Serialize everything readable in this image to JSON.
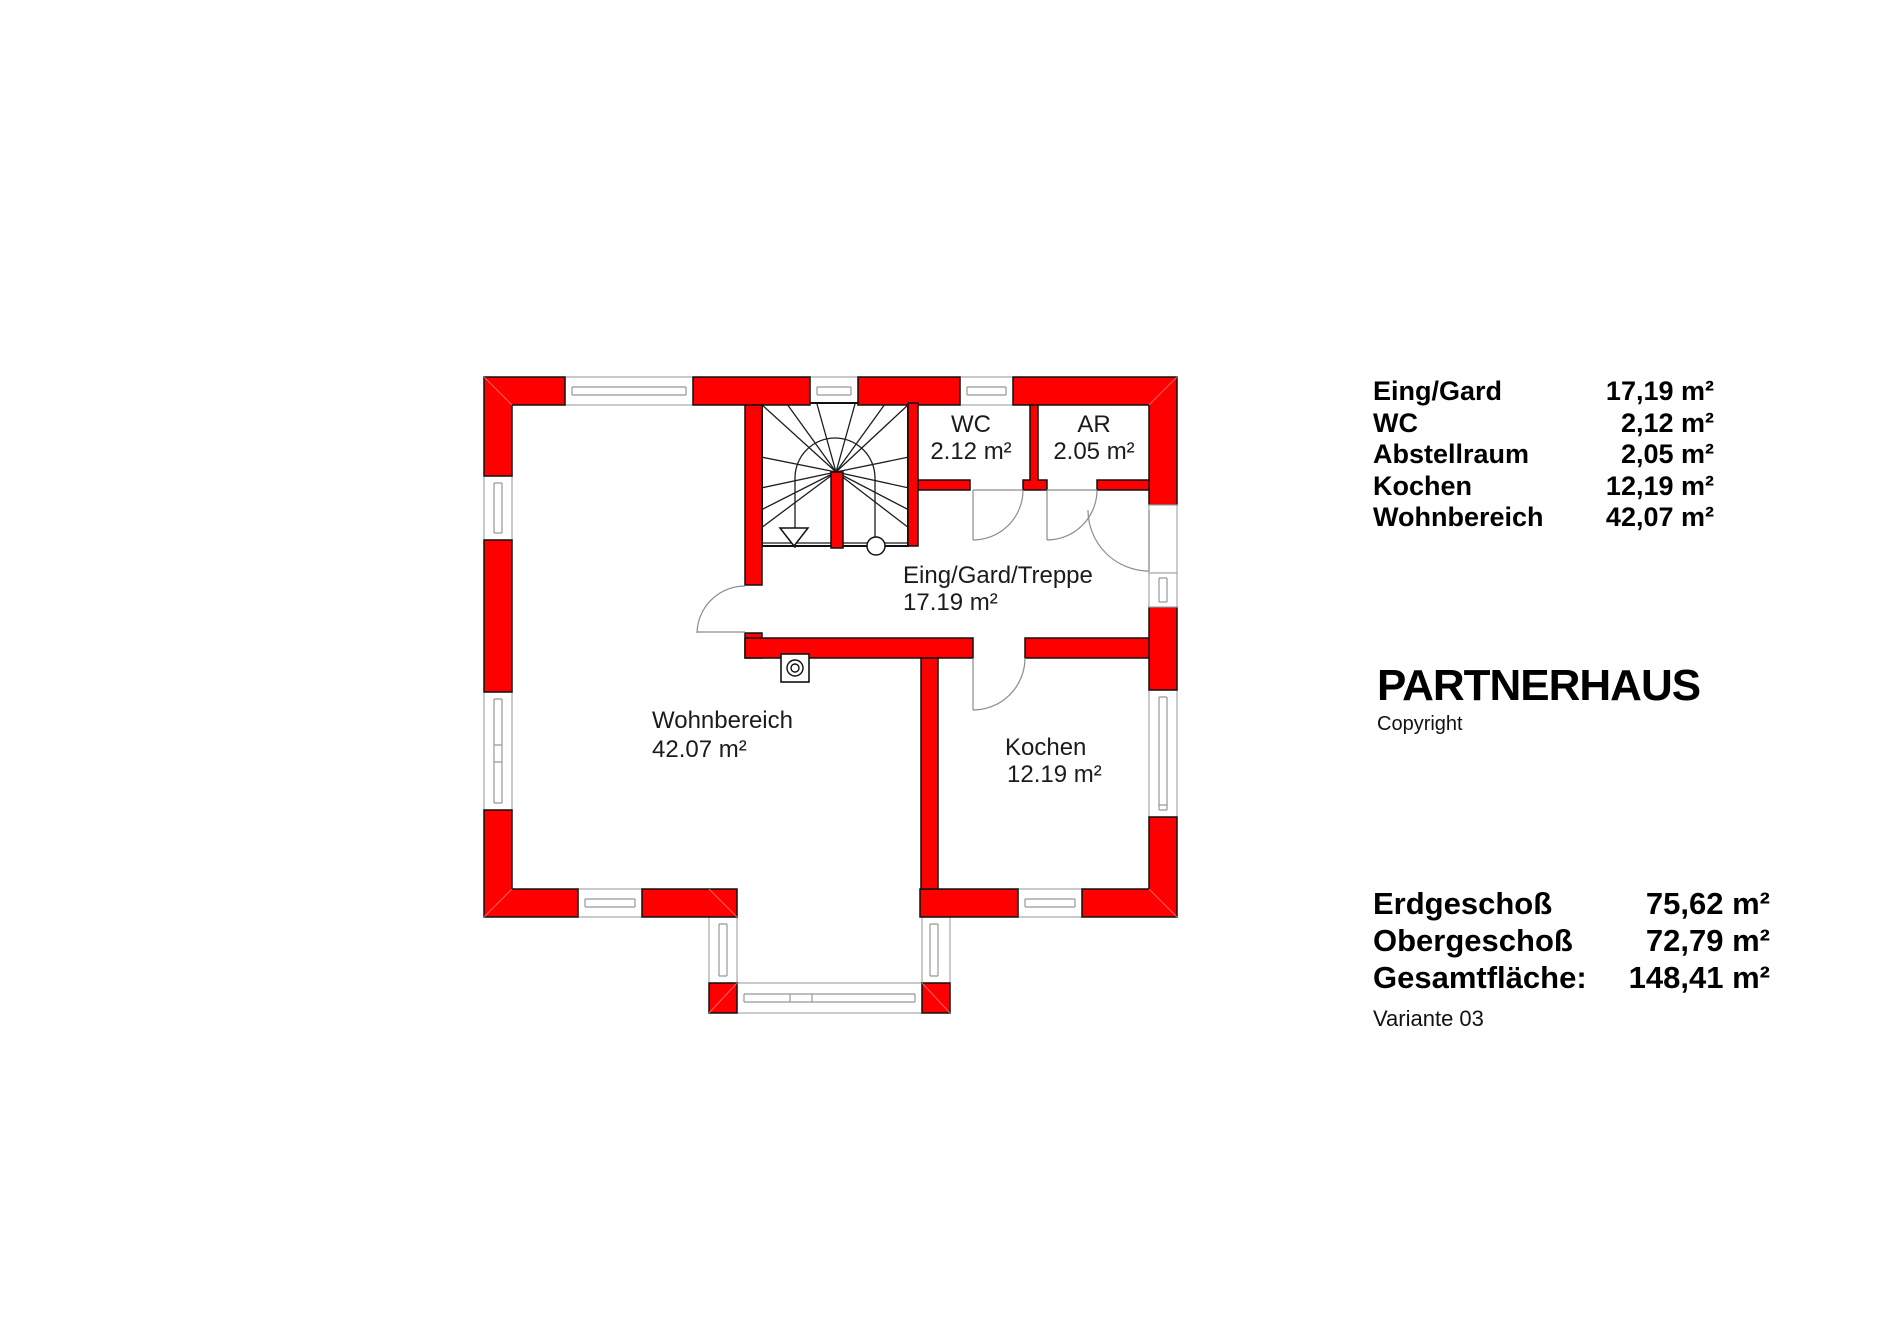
{
  "plan": {
    "rooms": [
      {
        "id": "wc",
        "label": "WC",
        "area": "2.12 m²"
      },
      {
        "id": "abstellraum",
        "label": "AR",
        "area": "2.05 m²"
      },
      {
        "id": "eingang",
        "label": "Eing/Gard/Treppe",
        "area": "17.19 m²"
      },
      {
        "id": "wohnbereich",
        "label": "Wohnbereich",
        "area": "42.07 m²"
      },
      {
        "id": "kochen",
        "label": "Kochen",
        "area": "12.19 m²"
      }
    ]
  },
  "legend": {
    "rows": [
      {
        "label": "Eing/Gard",
        "value": "17,19 m²"
      },
      {
        "label": "WC",
        "value": "2,12 m²"
      },
      {
        "label": "Abstellraum",
        "value": "2,05 m²"
      },
      {
        "label": "Kochen",
        "value": "12,19 m²"
      },
      {
        "label": "Wohnbereich",
        "value": "42,07 m²"
      }
    ]
  },
  "brand": {
    "title": "PARTNERHAUS",
    "copyright": "Copyright"
  },
  "totals": {
    "rows": [
      {
        "label": "Erdgeschoß",
        "value": "75,62 m²"
      },
      {
        "label": "Obergeschoß",
        "value": "72,79 m²"
      },
      {
        "label": "Gesamtfläche:",
        "value": "148,41 m²"
      }
    ],
    "variant": "Variante 03"
  },
  "colors": {
    "wall": "#ff0000",
    "wall_outline": "#111111",
    "window_frame": "#a8a8a8",
    "door": "#8c8c8c",
    "text": "#1b1b1b"
  }
}
